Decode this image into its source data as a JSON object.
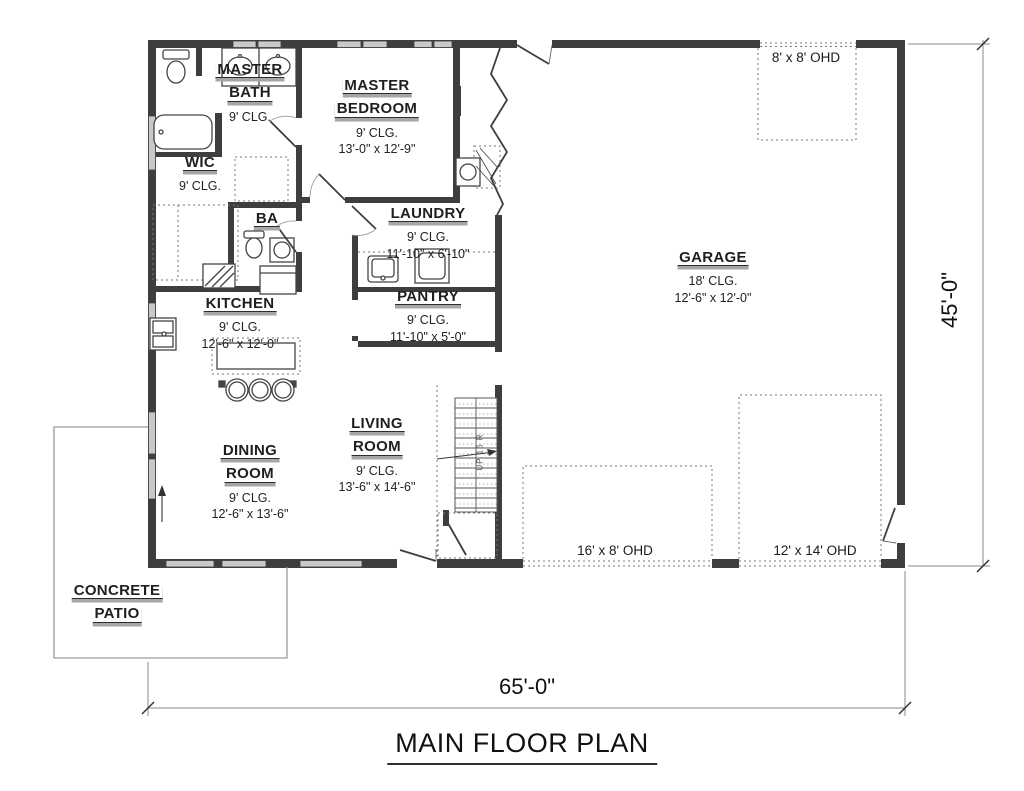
{
  "title": "MAIN FLOOR PLAN",
  "dimensions": {
    "overall_width": "65'-0\"",
    "overall_height": "45'-0\""
  },
  "rooms": {
    "master_bath": {
      "lines": [
        "MASTER",
        "BATH"
      ],
      "clg": "9' CLG.",
      "size": ""
    },
    "master_bedroom": {
      "lines": [
        "MASTER",
        "BEDROOM"
      ],
      "clg": "9' CLG.",
      "size": "13'-0\" x 12'-9\""
    },
    "wic": {
      "lines": [
        "WIC"
      ],
      "clg": "9' CLG.",
      "size": ""
    },
    "ba": {
      "lines": [
        "BA"
      ],
      "clg": "",
      "size": ""
    },
    "laundry": {
      "lines": [
        "LAUNDRY"
      ],
      "clg": "9' CLG.",
      "size": "11'-10\" x 6'-10\""
    },
    "pantry": {
      "lines": [
        "PANTRY"
      ],
      "clg": "9' CLG.",
      "size": "11'-10\" x 5'-0\""
    },
    "kitchen": {
      "lines": [
        "KITCHEN"
      ],
      "clg": "9' CLG.",
      "size": "12'-6\" x 12'-0\""
    },
    "dining": {
      "lines": [
        "DINING",
        "ROOM"
      ],
      "clg": "9' CLG.",
      "size": "12'-6\" x 13'-6\""
    },
    "living": {
      "lines": [
        "LIVING",
        "ROOM"
      ],
      "clg": "9' CLG.",
      "size": "13'-6\" x 14'-6\""
    },
    "garage": {
      "lines": [
        "GARAGE"
      ],
      "clg": "18' CLG.",
      "size": "12'-6\" x 12'-0\""
    },
    "patio": {
      "lines": [
        "CONCRETE",
        "PATIO"
      ],
      "clg": "",
      "size": ""
    }
  },
  "overhead_doors": {
    "ohd_8x8": "8' x 8' OHD",
    "ohd_16x8": "16' x 8' OHD",
    "ohd_12x14": "12' x 14' OHD"
  },
  "stairs_label": "UP 16 R",
  "colors": {
    "wall": "#3e3e3e",
    "window": "#c9c9c9",
    "underline": "#a6a6a6",
    "dashed": "#777777"
  }
}
